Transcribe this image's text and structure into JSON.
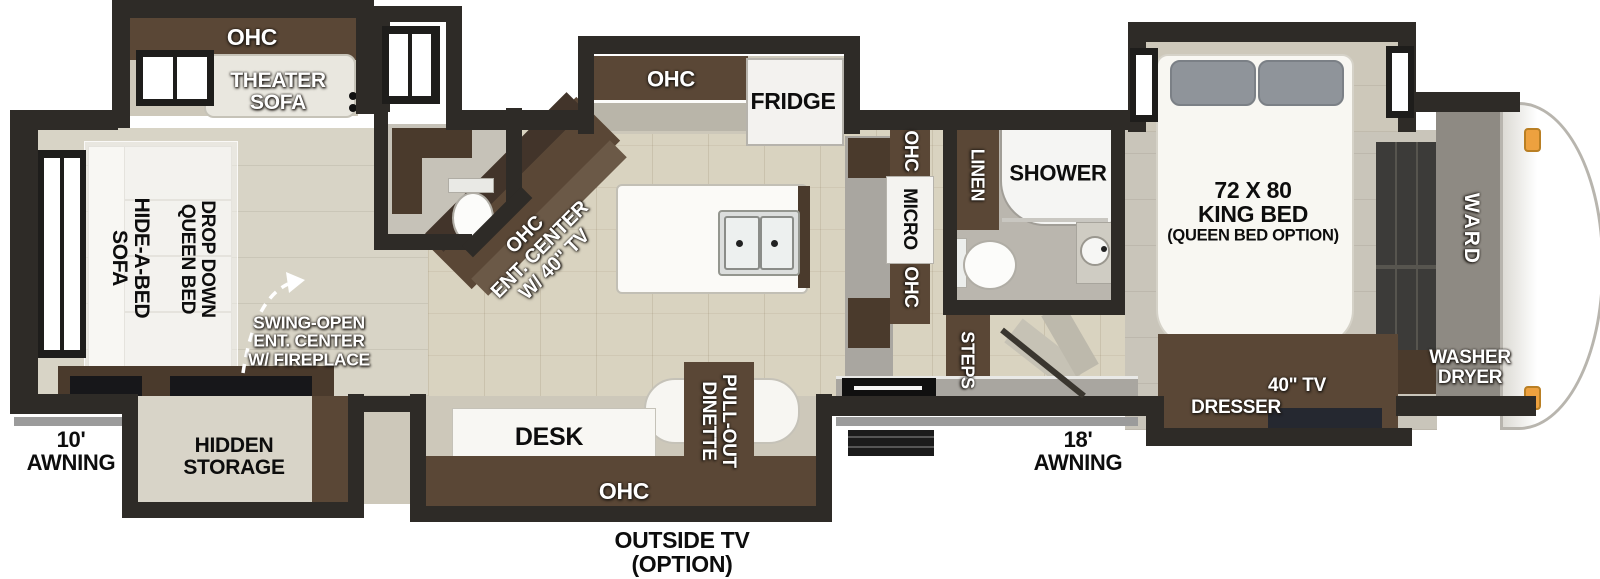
{
  "title": "Fifth wheel RV floorplan",
  "colors": {
    "wall": "#2e2b27",
    "floor": "#d9d3c0",
    "floor_light": "#d8d4c6",
    "floor_gray": "#c9c5ba",
    "slide_floor": "#cdc8ba",
    "brown": "#5a4736",
    "brown_dark": "#4a3a2c",
    "counter": "#a9a6a0",
    "sofa": "#eae8e1",
    "pillow": "#8f949a",
    "orange": "#eda13f",
    "awning": "#9b9b9b"
  },
  "labels": {
    "rear_slideout_ohc": "OHC",
    "theater_sofa": "THEATER\nSOFA",
    "hide_a_bed_sofa": "HIDE-A-BED\nSOFA",
    "drop_down_queen_bed": "DROP DOWN\nQUEEN BED",
    "swing_open_ent_center": "SWING-OPEN\nENT. CENTER\nW/ FIREPLACE",
    "awning_rear": "10'\nAWNING",
    "hidden_storage": "HIDDEN\nSTORAGE",
    "kitchen_ohc": "OHC",
    "fridge": "FRIDGE",
    "ent_center": "OHC\nENT. CENTER\nW/ 40\" TV",
    "ohc_upper": "OHC",
    "micro": "MICRO",
    "ohc_lower": "OHC",
    "linen": "LINEN",
    "shower": "SHOWER",
    "steps": "STEPS",
    "king_bed": "72 X 80\nKING BED",
    "king_bed_option": "(QUEEN BED OPTION)",
    "ward": "WARD",
    "washer_dryer": "WASHER\nDRYER",
    "dresser": "DRESSER",
    "tv_40": "40\" TV",
    "awning_front": "18'\nAWNING",
    "desk": "DESK",
    "desk_ohc": "OHC",
    "pull_out_dinette": "PULL-OUT\nDINETTE",
    "outside_tv": "OUTSIDE TV\n(OPTION)"
  }
}
